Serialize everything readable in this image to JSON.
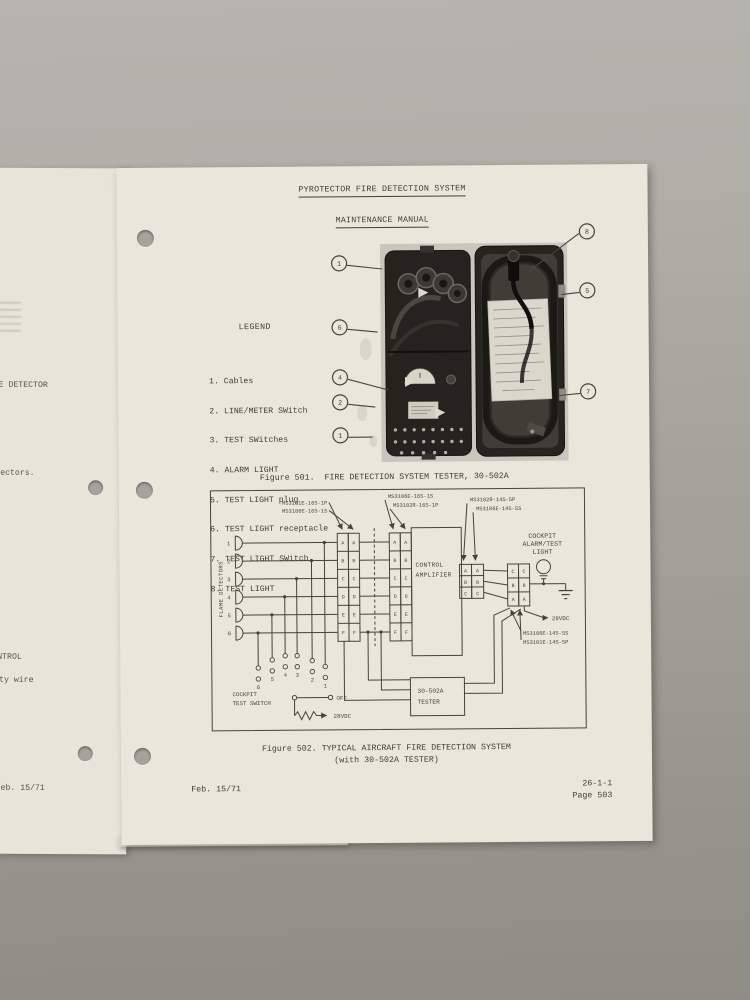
{
  "doc": {
    "title": "PYROTECTOR FIRE DETECTION SYSTEM",
    "subtitle": "MAINTENANCE MANUAL",
    "footer_left": "Feb. 15/71",
    "footer_code": "26-1-1",
    "footer_page": "Page 503"
  },
  "under_page": {
    "f1": "E DETECTOR",
    "f2": "ectors.",
    "f3": "NTROL",
    "f4": "ty wire",
    "f5": "eb. 15/71"
  },
  "legend": {
    "heading": "LEGEND",
    "items": [
      "1. Cables",
      "2. LINE/METER SWitch",
      "3. TEST SWitches",
      "4. ALARM LIGHT",
      "5. TEST LIGHT plug",
      "6. TEST LIGHT receptacle",
      "7. TEST LIGHT SWitch",
      "8. TEST LIGHT"
    ]
  },
  "fig501": {
    "caption": "Figure 501.  FIRE DETECTION SYSTEM TESTER, 30-502A",
    "callouts": [
      "1",
      "6",
      "4",
      "2",
      "1",
      "8",
      "5",
      "7"
    ]
  },
  "fig502": {
    "caption1": "Figure 502. TYPICAL AIRCRAFT FIRE DETECTION SYSTEM",
    "caption2": "(with 30-502A TESTER)",
    "flame_detectors": "FLAME DETECTORS",
    "conn1a": "MS3101E-16S-1P",
    "conn1b": "MS3106E-16S-1S",
    "conn2a": "MS3106E-16S-1S",
    "conn2b": "MS3102R-16S-1P",
    "conn3a": "MS3102R-14S-5P",
    "conn3b": "MS3106E-14S-5S",
    "conn4a": "MS3106E-14S-5S",
    "conn4b": "MS3101E-14S-5P",
    "amp1": "CONTROL",
    "amp2": "AMPLIFIER",
    "light1": "COCKPIT",
    "light2": "ALARM/TEST",
    "light3": "LIGHT",
    "tester1": "30-502A",
    "tester2": "TESTER",
    "switch1": "COCKPIT",
    "switch2": "TEST SWITCH",
    "off": "OFF",
    "vdc_sw": "28VDC",
    "vdc_r": "28VDC",
    "dets": [
      "1",
      "2",
      "3",
      "4",
      "5",
      "6"
    ],
    "sw_nums": [
      "6",
      "5",
      "4",
      "3",
      "2",
      "1"
    ],
    "pins": [
      "A",
      "B",
      "C",
      "D",
      "E",
      "F"
    ],
    "abc": [
      "A",
      "B",
      "C"
    ],
    "cba": [
      "C",
      "B",
      "A"
    ]
  }
}
